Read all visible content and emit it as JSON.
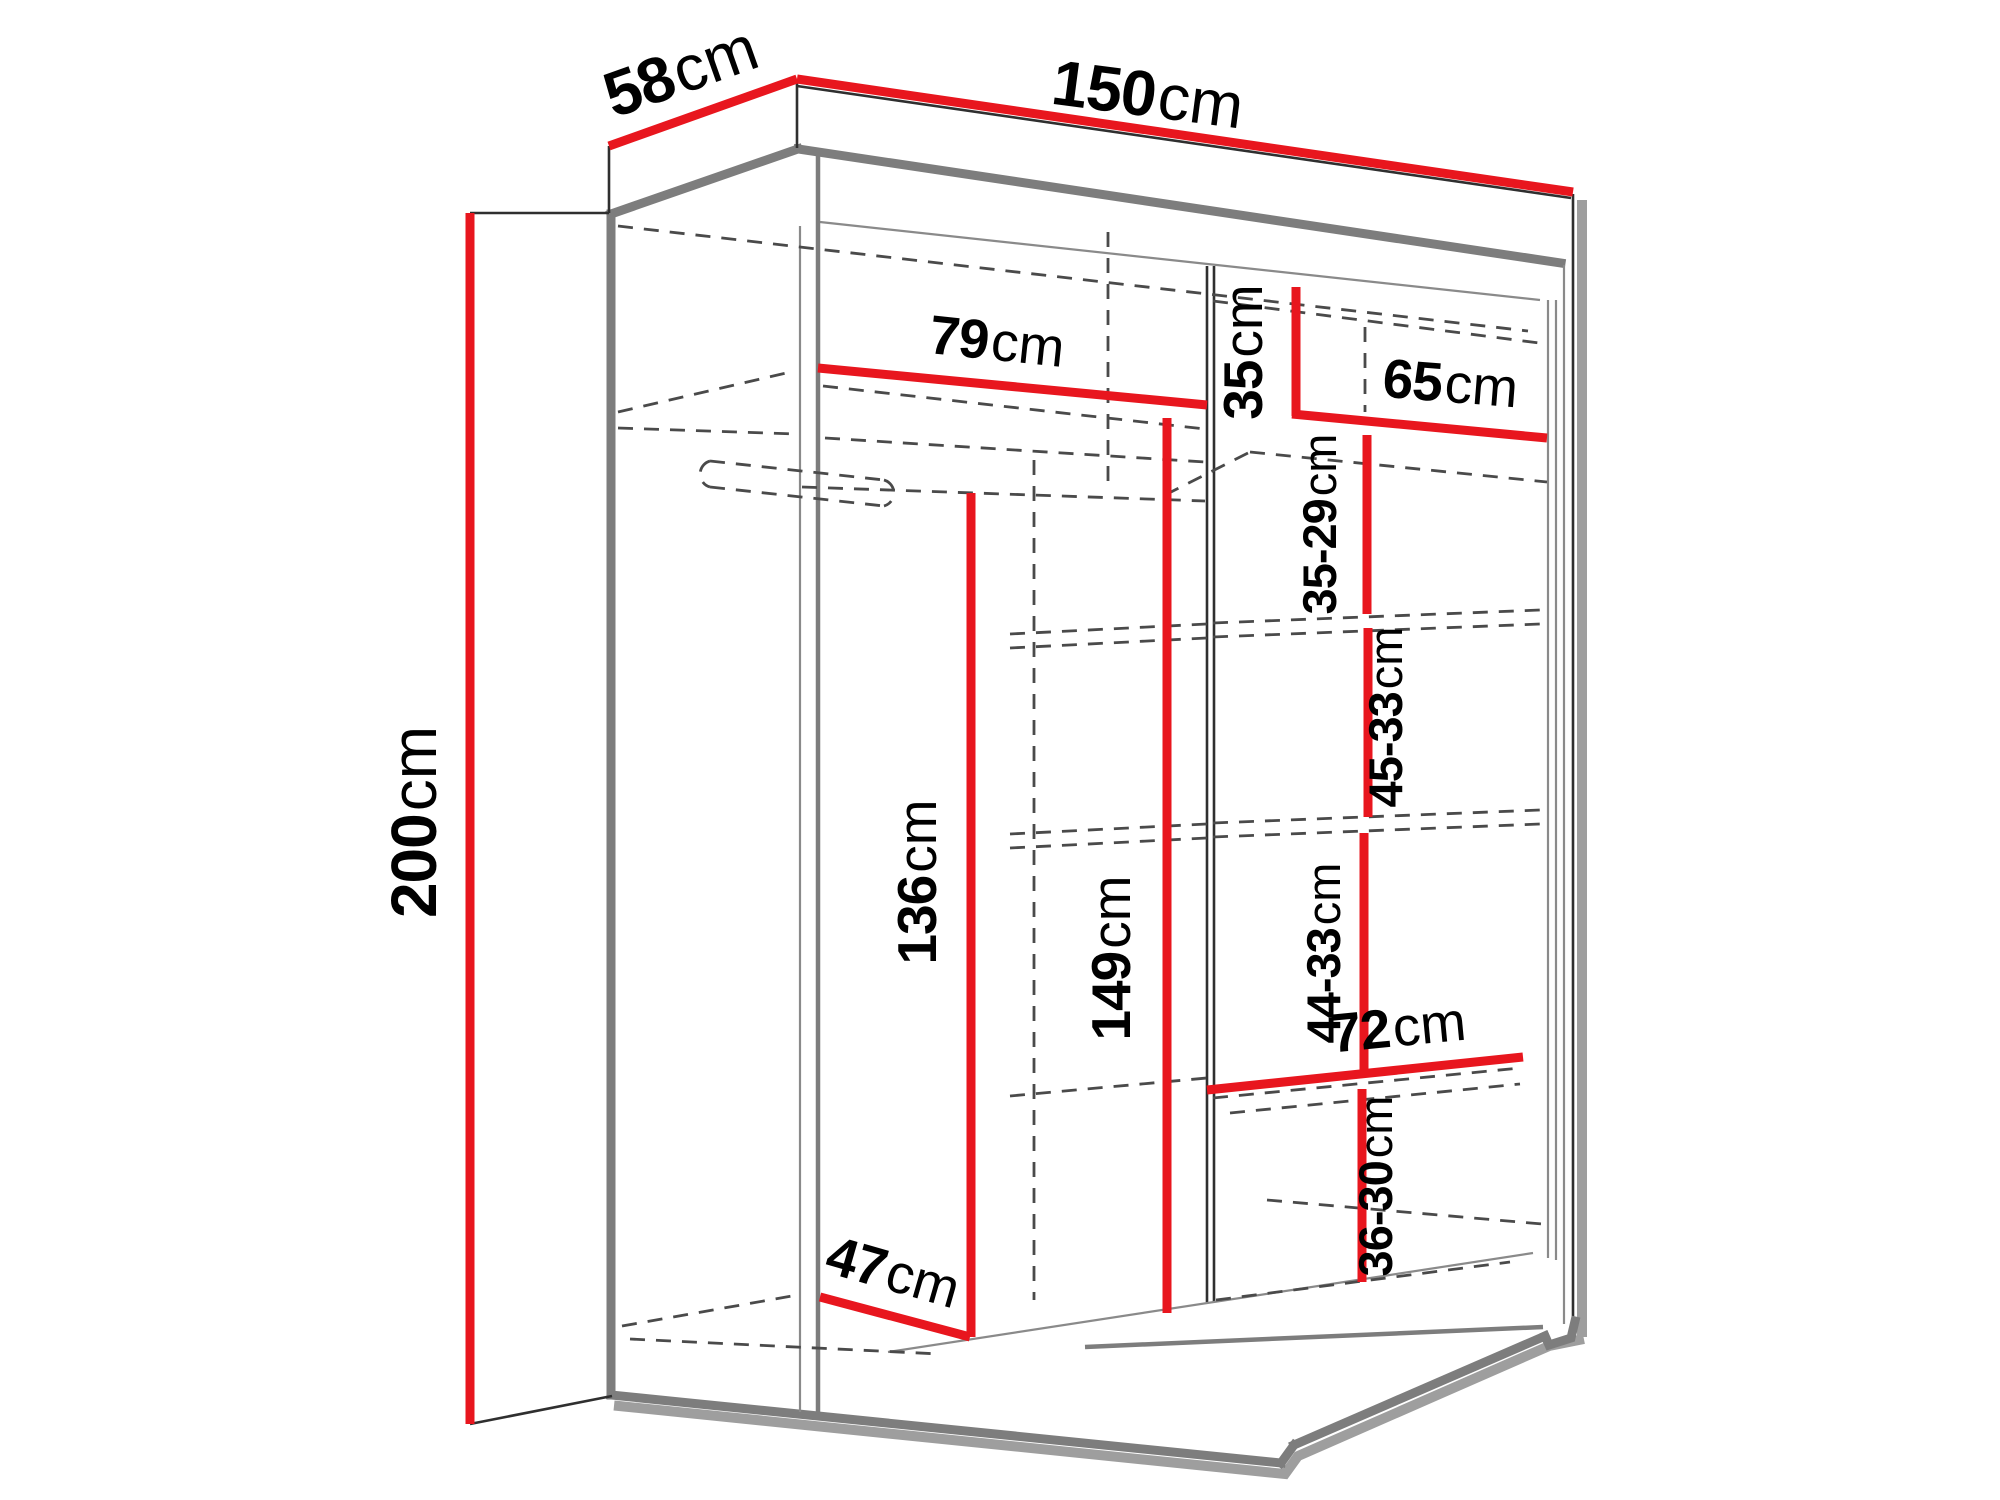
{
  "diagram": {
    "kind": "wardrobe-dimension-diagram",
    "unit": "cm",
    "colors": {
      "dimension_red": "#e8161e",
      "outline_gray": "#7d7d7d",
      "line_dark": "#2f2f2f",
      "dashed_gray": "#4a4a4a",
      "shadow_gray": "#9e9e9e",
      "text_black": "#000000",
      "background": "#ffffff"
    }
  },
  "dimensions": {
    "height": {
      "value": "200",
      "unit": "cm"
    },
    "width": {
      "value": "150",
      "unit": "cm"
    },
    "depth": {
      "value": "58",
      "unit": "cm"
    },
    "left_shelf_width": {
      "value": "79",
      "unit": "cm"
    },
    "top_right_height": {
      "value": "35",
      "unit": "cm"
    },
    "right_shelf_width": {
      "value": "65",
      "unit": "cm"
    },
    "right_gap_1": {
      "value": "35-29",
      "unit": "cm"
    },
    "right_gap_2": {
      "value": "45-33",
      "unit": "cm"
    },
    "hanging_height": {
      "value": "136",
      "unit": "cm"
    },
    "middle_height": {
      "value": "149",
      "unit": "cm"
    },
    "right_gap_3": {
      "value": "44-33",
      "unit": "cm"
    },
    "bottom_shelf_width": {
      "value": "72",
      "unit": "cm"
    },
    "right_gap_4": {
      "value": "36-30",
      "unit": "cm"
    },
    "interior_depth": {
      "value": "47",
      "unit": "cm"
    }
  }
}
